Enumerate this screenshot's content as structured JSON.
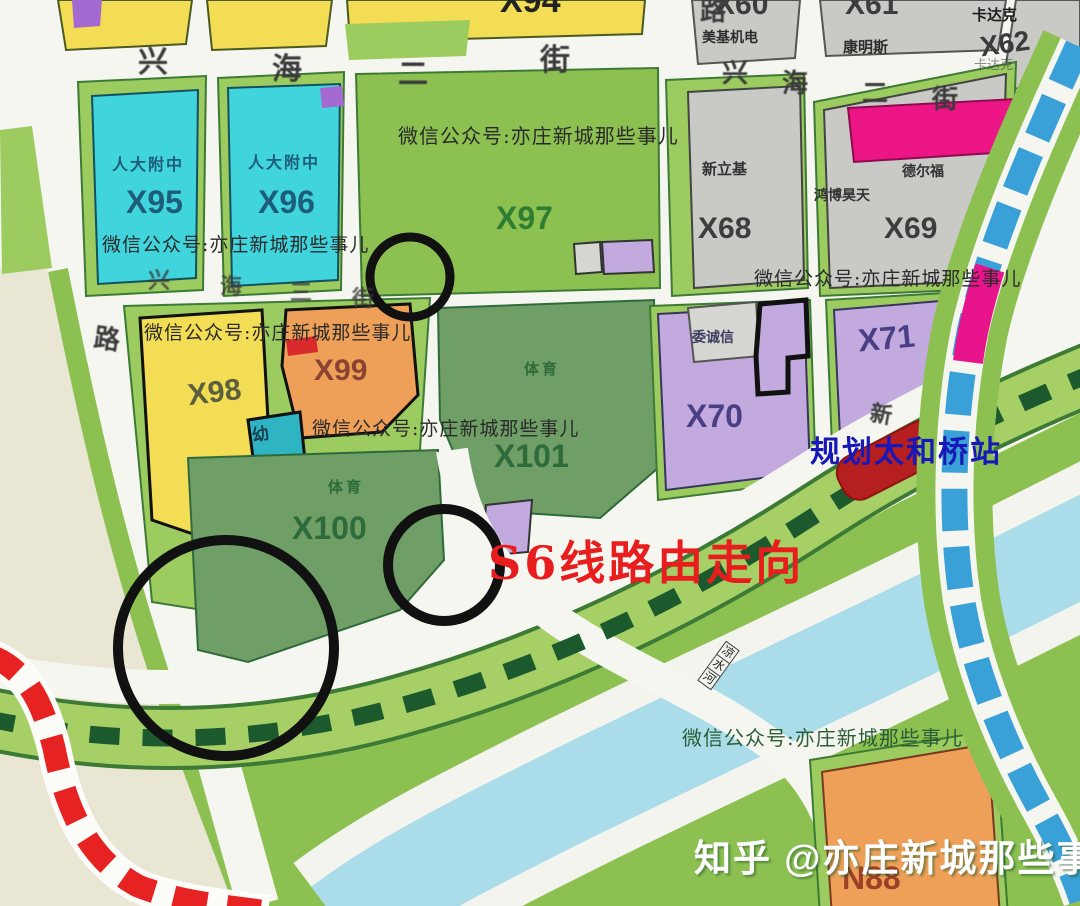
{
  "title": "亦庄新城规划图 S6线路由走向",
  "watermarks": {
    "wechat": "微信公众号:亦庄新城那些事儿",
    "zhihu": "知乎 @亦庄新城那些事儿"
  },
  "annotations": {
    "s6_route_title": "S6线路由走向",
    "planned_station": "规划太和桥站",
    "bridge_chars": [
      "凉",
      "水",
      "河"
    ]
  },
  "streets": {
    "xinghai2_left": [
      "兴",
      "海",
      "二",
      "街"
    ],
    "xinghai2_right": [
      "兴",
      "海",
      "二",
      "街"
    ],
    "xinghai3": [
      "兴",
      "海",
      "三",
      "街"
    ],
    "lu_top": "路",
    "lu_left": "路",
    "xin_char": "新"
  },
  "parcels": {
    "x94": {
      "label": "X94"
    },
    "x95": {
      "sub": "人大附中",
      "label": "X95"
    },
    "x96": {
      "sub": "人大附中",
      "label": "X96"
    },
    "x97": {
      "label": "X97"
    },
    "x98": {
      "label": "X98"
    },
    "x99": {
      "label": "X99"
    },
    "x100": {
      "sub": "体育",
      "label": "X100"
    },
    "x101": {
      "sub": "体育",
      "label": "X101"
    },
    "x60": {
      "sub": "美基机电",
      "label": "X60"
    },
    "x61": {
      "sub": "康明斯",
      "label": "X61"
    },
    "x62": {
      "sub": "卡达克",
      "label": "X62",
      "sub2": "卡达克"
    },
    "x68": {
      "sub": "新立基",
      "label": "X68"
    },
    "x69": {
      "sub": "鸿博昊天",
      "sub2": "德尔福",
      "label": "X69"
    },
    "x70": {
      "sub": "委诚信",
      "label": "X70"
    },
    "x71": {
      "label": "X71"
    },
    "n88": {
      "label": "N88"
    },
    "kindergarten": {
      "label": "幼"
    }
  },
  "colors": {
    "road_white": "#f6f6f1",
    "cream": "#e9e7d4",
    "green_light": "#9ccb60",
    "green_mid": "#8cc152",
    "sage": "#6f9e66",
    "cyan": "#40d4dd",
    "teal_small": "#2fb4c4",
    "yellow": "#f2dd55",
    "orange": "#efa058",
    "gray_parcel": "#c9c9c6",
    "gray_small": "#d6d6d2",
    "purple": "#c2aade",
    "purple_accent": "#a569d2",
    "pink": "#ec1585",
    "red_station": "#b51f1f",
    "red_line": "#e62222",
    "red_accent": "#d92b2b",
    "s6_dash": "#1c5a2e",
    "band_fill": "#a6d065",
    "band_edge": "#3c7a35",
    "river": "#aadcea",
    "blue_line": "#3aa0d8",
    "magenta_segment": "#e8148c",
    "circle_black": "#111111"
  }
}
